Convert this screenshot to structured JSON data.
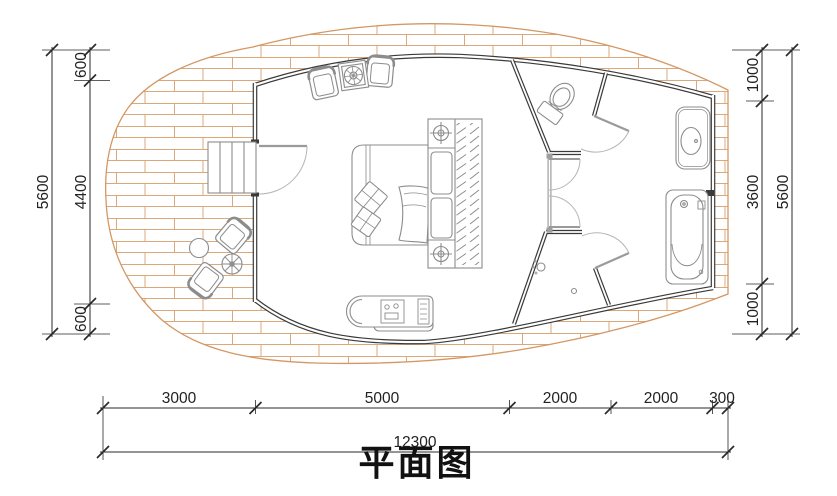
{
  "title": "平面图",
  "plan": {
    "type": "architectural-floor-plan",
    "colors": {
      "deck_line": "#d99e6b",
      "wall": "#3a3a3a",
      "furniture_line": "#8c8c8c",
      "dimension": "#222222",
      "background": "#ffffff"
    },
    "rooms": [
      "deck-terrace",
      "bedroom",
      "toilet-room",
      "vestibule",
      "shower-room",
      "bathroom"
    ],
    "furniture": [
      "entry-stairs",
      "entry-door",
      "armchairs-with-side-table",
      "double-bed",
      "nightstand-lamps",
      "wardrobe",
      "chaise-bench",
      "outdoor-chairs",
      "outdoor-round-table",
      "parasol-table",
      "toilet",
      "vanity-sink",
      "bathtub",
      "shower-head",
      "floor-drain"
    ]
  },
  "dimensions": {
    "left": {
      "total": "5600",
      "segments": [
        "600",
        "4400",
        "600"
      ]
    },
    "right": {
      "total": "5600",
      "segments": [
        "1000",
        "3600",
        "1000"
      ]
    },
    "bottom": {
      "total": "12300",
      "segments": [
        "3000",
        "5000",
        "2000",
        "2000",
        "300"
      ]
    }
  }
}
